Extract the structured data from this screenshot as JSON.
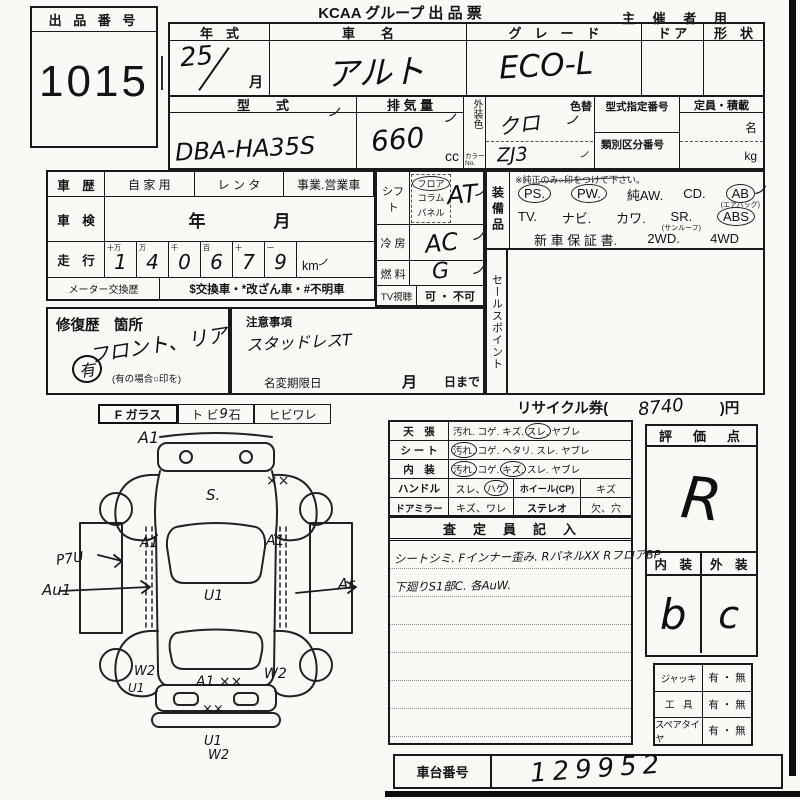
{
  "marks": {
    "tick": "ノ"
  },
  "header": {
    "title": "KCAA グループ 出 品 票",
    "audience": "主 催 者 用"
  },
  "lot": {
    "label": "出 品 番 号",
    "number": "1015"
  },
  "vehicle": {
    "year": {
      "label": "年　式",
      "value": "25",
      "unit": "月"
    },
    "name": {
      "label": "車　　名",
      "value": "アルト"
    },
    "grade": {
      "label": "グ　レ　ー　ド",
      "value": "ECO-L"
    },
    "door": {
      "label": "ド ア"
    },
    "shape": {
      "label": "形　状"
    },
    "model": {
      "label": "型　　式",
      "value": "DBA-HA35S"
    },
    "displacement": {
      "label": "排 気 量",
      "value": "660",
      "unit": "cc"
    },
    "color": {
      "label": "外装色",
      "no_label": "カラーNo.",
      "value": "クロ",
      "no_value": "ZJ3",
      "change_label": "色替"
    },
    "designation_no": {
      "label": "型式指定番号"
    },
    "class_no": {
      "label": "類別区分番号"
    },
    "capacity": {
      "label": "定員・積載",
      "persons_unit": "名",
      "weight_unit": "kg"
    }
  },
  "history": {
    "label": "車　歴",
    "options": [
      "自 家 用",
      "レ ン タ",
      "事業.営業車"
    ]
  },
  "inspection": {
    "label": "車　検",
    "value": "年　　　　月"
  },
  "mileage": {
    "label": "走　行",
    "digits": [
      {
        "place": "十万",
        "digit": "1"
      },
      {
        "place": "万",
        "digit": "4"
      },
      {
        "place": "千",
        "digit": "0"
      },
      {
        "place": "百",
        "digit": "6"
      },
      {
        "place": "十",
        "digit": "7"
      },
      {
        "place": "一",
        "digit": "9"
      }
    ],
    "unit": "km"
  },
  "meter": {
    "label": "メーター交換歴",
    "legend": "$交換車・*改ざん車・#不明車"
  },
  "shift": {
    "label": "シフト",
    "options": [
      {
        "text": "フロア",
        "circled": true
      },
      {
        "text": "コラム"
      },
      {
        "text": "パネル"
      }
    ],
    "value": "AT"
  },
  "aircon": {
    "label": "冷 房",
    "value": "AC"
  },
  "fuel": {
    "label": "燃 料",
    "value": "G"
  },
  "tv": {
    "label": "TV視聴",
    "value": "可 ・ 不可"
  },
  "equipment": {
    "label": "装備品",
    "note": "※純正のみ○印をつけて下さい。",
    "line1": [
      {
        "label": "PS.",
        "circled": true
      },
      {
        "label": "PW.",
        "circled": true
      },
      {
        "label": "純AW."
      },
      {
        "label": "CD."
      },
      {
        "label": "AB",
        "sub": "(エアバッグ)",
        "circled": true
      }
    ],
    "line2": [
      {
        "label": "TV."
      },
      {
        "label": "ナビ."
      },
      {
        "label": "カワ."
      },
      {
        "label": "SR.",
        "sub": "(サンルーフ)"
      },
      {
        "label": "ABS",
        "circled": true
      }
    ],
    "line3": [
      {
        "label": "新 車 保 証 書."
      },
      {
        "label": "2WD."
      },
      {
        "label": "4WD"
      }
    ]
  },
  "sales_point": {
    "label": "セールスポイント"
  },
  "repair": {
    "label": "修復歴　箇所",
    "value": "フロント、リア",
    "mark": "有",
    "note": "(有の場合○印を)"
  },
  "caution": {
    "label": "注意事項",
    "value": "スタッドレスT",
    "deadline_label": "名変期限日",
    "month_label": "月",
    "day_label": "日まで"
  },
  "glass": {
    "label": "F ガラス",
    "stone": {
      "prefix": "ト ビ",
      "mark": "9",
      "suffix": "石"
    },
    "crack": "ヒビワレ"
  },
  "recycle": {
    "prefix": "リサイクル券(",
    "value": "8740",
    "suffix": ")円"
  },
  "condition": {
    "rows3": [
      {
        "label": "天　張",
        "items": [
          {
            "text": "汚れ."
          },
          {
            "text": "コゲ."
          },
          {
            "text": "キズ."
          },
          {
            "text": "スレ.",
            "circled": true
          },
          {
            "text": "ヤブレ"
          }
        ]
      },
      {
        "label": "シ ー ト",
        "items": [
          {
            "text": "汚れ.",
            "circled": true
          },
          {
            "text": "コゲ."
          },
          {
            "text": "ヘタリ."
          },
          {
            "text": "スレ."
          },
          {
            "text": "ヤブレ"
          }
        ]
      },
      {
        "label": "内　装",
        "items": [
          {
            "text": "汚れ.",
            "circled": true
          },
          {
            "text": "コゲ."
          },
          {
            "text": "キズ.",
            "circled": true
          },
          {
            "text": "スレ."
          },
          {
            "text": "ヤブレ"
          }
        ]
      }
    ],
    "handle": {
      "label": "ハンドル",
      "value_prefix": "スレ、",
      "value_circled": "ハゲ",
      "label2": "ホイール(CP)",
      "value2": "キズ"
    },
    "mirror": {
      "label": "ドアミラー",
      "value": "キズ、ワレ",
      "label2": "ステレオ",
      "value2": "欠、穴"
    }
  },
  "inspector": {
    "header": "査　定　員　記　入",
    "lines": [
      "シートシミ. Fインナー歪み. RパネルXX RフロアBP",
      "下廻りS1部C. 各AuW."
    ]
  },
  "rating": {
    "header": "評　価　点",
    "value": "R",
    "interior_label": "内　装",
    "exterior_label": "外　装",
    "interior_value": "b",
    "exterior_value": "c"
  },
  "accessories": [
    {
      "label": "ジャッキ",
      "value": "有 ・ 無"
    },
    {
      "label": "工　具",
      "value": "有 ・ 無"
    },
    {
      "label": "スペアタイヤ",
      "value": "有 ・ 無"
    }
  ],
  "chassis": {
    "label": "車台番号",
    "value": "129952"
  },
  "diagram": {
    "labels": {
      "a1_top": "A1",
      "s_hood": "S.",
      "xx_front": "××",
      "a1_left": "A1",
      "a1_right": "A1",
      "p7u": "P7U",
      "au1": "Au1",
      "ar": "Ar",
      "u1_roof": "U1",
      "w2_left_rear": "W2",
      "u1_left_rear": "U1",
      "a1xx_trunk": "A1 ××",
      "w2_right_rear": "W2",
      "xx_rear": "××",
      "u1_bottom": "U1",
      "w2_bottom": "W2"
    }
  }
}
